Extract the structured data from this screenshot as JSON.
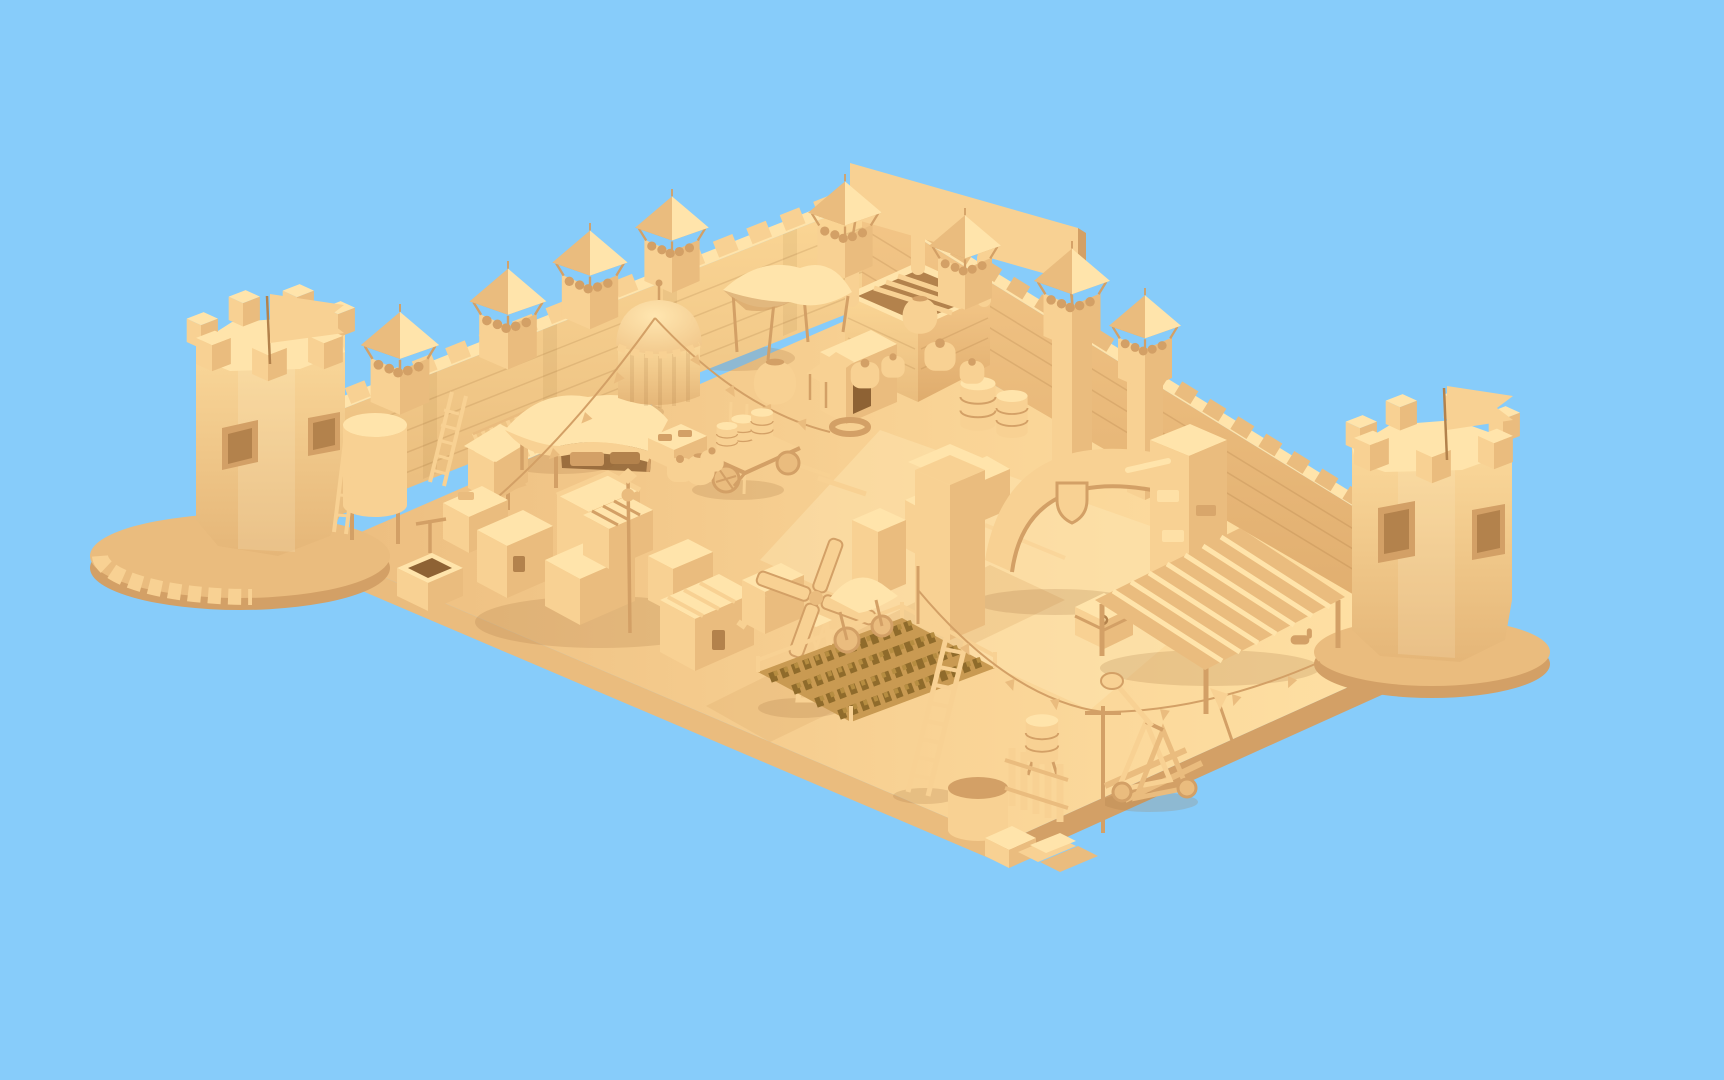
{
  "scene": {
    "title": "Low-poly medieval castle village — monochrome 3D render",
    "description": "Isometric low-poly 3D render of a walled medieval castle courtyard built entirely in cream-yellow material on a flat light-blue background. Two octagonal flag towers anchor the corners; crenellated curtain walls with wooden watchtowers enclose a market square with a domed pavilion, canopy tents, adobe houses, a windmill, a crop field, a gate arch with shield, a pergola stable, carts, barrels, ladders and a catapult.",
    "style": "monochrome cream low-poly isometric 3D render",
    "lighting": "warm sunlight from the upper right",
    "objects": [
      {
        "id": "sky-background",
        "label": "flat light blue backdrop"
      },
      {
        "id": "ground-platform",
        "label": "floating rectangular ground slab"
      },
      {
        "id": "left-flag-tower",
        "label": "octagonal corner tower with pennant flag and spiral stair"
      },
      {
        "id": "right-flag-tower",
        "label": "octagonal corner tower with pennant flag"
      },
      {
        "id": "northwest-curtain-wall",
        "label": "crenellated brick curtain wall"
      },
      {
        "id": "northeast-curtain-wall",
        "label": "crenellated brick curtain wall"
      },
      {
        "id": "wall-watchtowers",
        "label": "wooden watchtowers with pavilion roofs"
      },
      {
        "id": "keep-gatehouse",
        "label": "open-top brick keep with corner pillars"
      },
      {
        "id": "banner-plank",
        "label": "long blank banner board above the keep"
      },
      {
        "id": "dome-pavilion",
        "label": "round striped pavilion with dome"
      },
      {
        "id": "canopy-tent",
        "label": "four-post saddle canopy tent"
      },
      {
        "id": "market-stall",
        "label": "market stall with draped awning"
      },
      {
        "id": "village-houses",
        "label": "cluster of flat-roofed adobe houses"
      },
      {
        "id": "water-tank",
        "label": "cylindrical water tank with ladder"
      },
      {
        "id": "animal-pen",
        "label": "fenced pen on stilts"
      },
      {
        "id": "well-fountain",
        "label": "stone well with basin"
      },
      {
        "id": "keg-cart",
        "label": "wooden cart loaded with kegs"
      },
      {
        "id": "harvest-wagon",
        "label": "covered harvest wagon"
      },
      {
        "id": "gate-arch",
        "label": "courtyard gate arch with shield emblem"
      },
      {
        "id": "shield-emblem",
        "label": "blank heraldic shield on arch"
      },
      {
        "id": "pergola-stable",
        "label": "slatted pergola stable with horses"
      },
      {
        "id": "windmill",
        "label": "lattice-tower windmill"
      },
      {
        "id": "crop-field",
        "label": "fenced speckled crop field"
      },
      {
        "id": "wooden-ladder",
        "label": "tall leaning ladder"
      },
      {
        "id": "catapult",
        "label": "small wooden catapult"
      },
      {
        "id": "treasure-chest",
        "label": "chest with hook latch"
      },
      {
        "id": "barrels-and-tubs",
        "label": "barrels, tubs and crates"
      },
      {
        "id": "bunting-strings",
        "label": "pennant bunting strung from the pavilion"
      },
      {
        "id": "rope-pennant-line",
        "label": "sagging rope line with pennants"
      },
      {
        "id": "lamp-post",
        "label": "thin courtyard post"
      },
      {
        "id": "brick-stack",
        "label": "stack of bricks near the edge"
      }
    ]
  },
  "palette": {
    "sky": "#87ccfa",
    "top": "#ffe4ab",
    "lit": "#f8d193",
    "mid": "#eabc7e",
    "shade": "#d3a066",
    "dark": "#b3824c",
    "deep": "#8e6234",
    "soil": "#c99a52",
    "crop_dark": "#8f6b2b",
    "crop_light": "#b68d41",
    "shadow": "#a87845",
    "ground_light": "#ffe2a6",
    "ground_dark": "#ecbd7f"
  }
}
